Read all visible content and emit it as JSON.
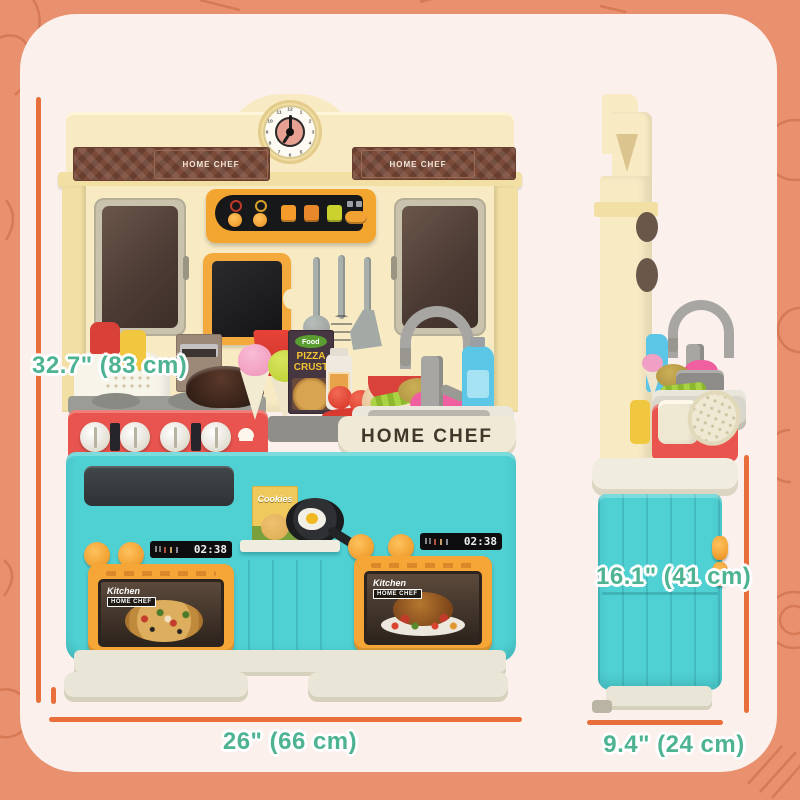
{
  "meta": {
    "description": "Kids play kitchen product dimension graphic, front and side views with measurement callouts"
  },
  "background": {
    "color": "#e9906f",
    "card_color": "#fbf0ec"
  },
  "dimension_annotations": {
    "text_color": "#4db392",
    "line_color": "#e86e3c",
    "height": {
      "label": "32.7\" (83 cm)"
    },
    "width": {
      "label": "26\" (66 cm)"
    },
    "depth": {
      "label": "9.4\" (24 cm)"
    },
    "side_height": {
      "label": "16.1\" (41 cm)"
    }
  },
  "kitchen_front": {
    "sign_left": "HOME CHEF",
    "sign_right": "HOME CHEF",
    "counter_brand": "HOME CHEF",
    "clock_numbers": [
      "12",
      "1",
      "2",
      "3",
      "4",
      "5",
      "6",
      "7",
      "8",
      "9",
      "10",
      "11"
    ],
    "left_oven": {
      "badge_line1": "Kitchen",
      "badge_line2": "HOME CHEF",
      "display_time": "02:38"
    },
    "right_oven": {
      "badge_line1": "Kitchen",
      "badge_line2": "HOME CHEF",
      "display_time": "02:38"
    },
    "shelf": {
      "cookies_label": "Cookies"
    },
    "counter_items": {
      "food_box_brand": "Food",
      "food_box_line1": "PIZZA",
      "food_box_line2": "CRUST"
    }
  },
  "colors": {
    "cream": "#f8ebc4",
    "teal_cabinet": "#4fd0d3",
    "stove_red": "#e9554e",
    "oven_orange": "#f5a637",
    "sign_brown": "#7b4a38",
    "panel_black": "#17181a"
  }
}
